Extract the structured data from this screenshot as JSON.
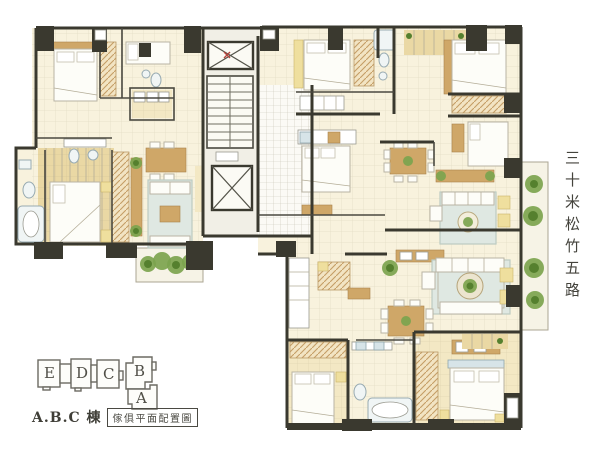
{
  "road_label": {
    "text": "三十米松竹五路",
    "orientation": "vertical"
  },
  "key_plan": {
    "units": [
      {
        "label": "E"
      },
      {
        "label": "D"
      },
      {
        "label": "C"
      },
      {
        "label": "B"
      },
      {
        "label": "A"
      }
    ],
    "building_label": "A.B.C 棟",
    "caption": "傢俱平面配置圖"
  },
  "drawing": {
    "type": "residential-floor-plan",
    "features": [
      "elevator-shafts",
      "staircase",
      "tiled-lobby",
      "bedrooms",
      "bathrooms",
      "living-rooms",
      "dining-areas",
      "kitchens",
      "wardrobes",
      "balcony-planting"
    ]
  },
  "colors": {
    "wall": "#3a392f",
    "floor-cream": "#f8f2dd",
    "floor-yellow": "#f3e8c4",
    "floor-wood": "#ead8a4",
    "wood": "#cfa768",
    "plant-green": "#7ca44e",
    "plant-dark": "#55802e",
    "bath-blue": "#d7e4e8",
    "rug": "#dfe8e2",
    "line-gray": "#b9b4a4",
    "keyplan-line": "#6b6a62",
    "text-dark": "#44433c"
  }
}
